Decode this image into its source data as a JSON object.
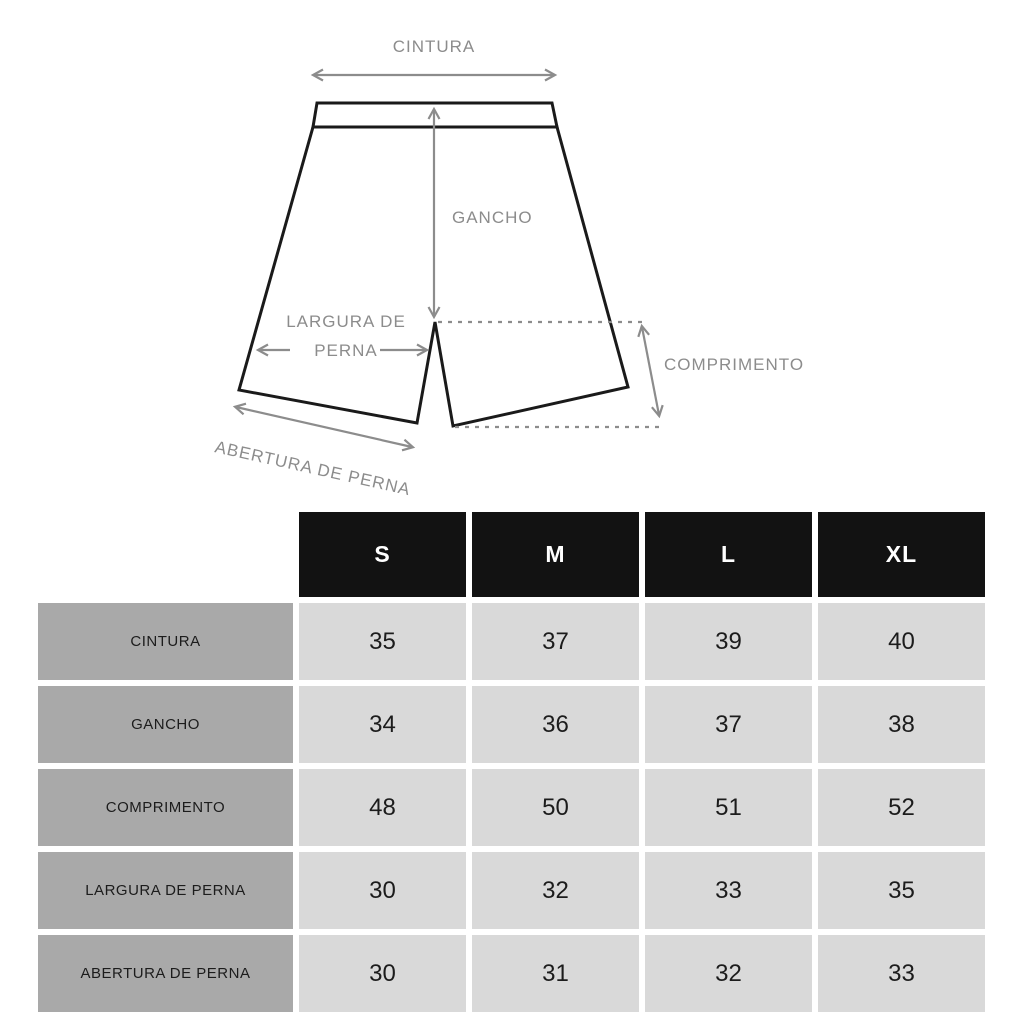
{
  "diagram": {
    "labels": {
      "waist": "CINTURA",
      "rise": "GANCHO",
      "leg_width_line1": "LARGURA DE",
      "leg_width_line2": "PERNA",
      "length": "COMPRIMENTO",
      "leg_opening": "ABERTURA DE PERNA"
    }
  },
  "table": {
    "columns": [
      "S",
      "M",
      "L",
      "XL"
    ],
    "rows": [
      {
        "label": "CINTURA",
        "values": [
          "35",
          "37",
          "39",
          "40"
        ]
      },
      {
        "label": "GANCHO",
        "values": [
          "34",
          "36",
          "37",
          "38"
        ]
      },
      {
        "label": "COMPRIMENTO",
        "values": [
          "48",
          "50",
          "51",
          "52"
        ]
      },
      {
        "label": "LARGURA DE PERNA",
        "values": [
          "30",
          "32",
          "33",
          "35"
        ]
      },
      {
        "label": "ABERTURA DE PERNA",
        "values": [
          "30",
          "31",
          "32",
          "33"
        ]
      }
    ]
  },
  "colors": {
    "line_black": "#1a1a1a",
    "annotation_gray": "#8c8c8c",
    "header_bg": "#121212",
    "header_text": "#ffffff",
    "label_cell_bg": "#a9a9a9",
    "value_cell_bg": "#d9d9d9",
    "cell_text": "#1c1c1c",
    "background": "#ffffff"
  }
}
